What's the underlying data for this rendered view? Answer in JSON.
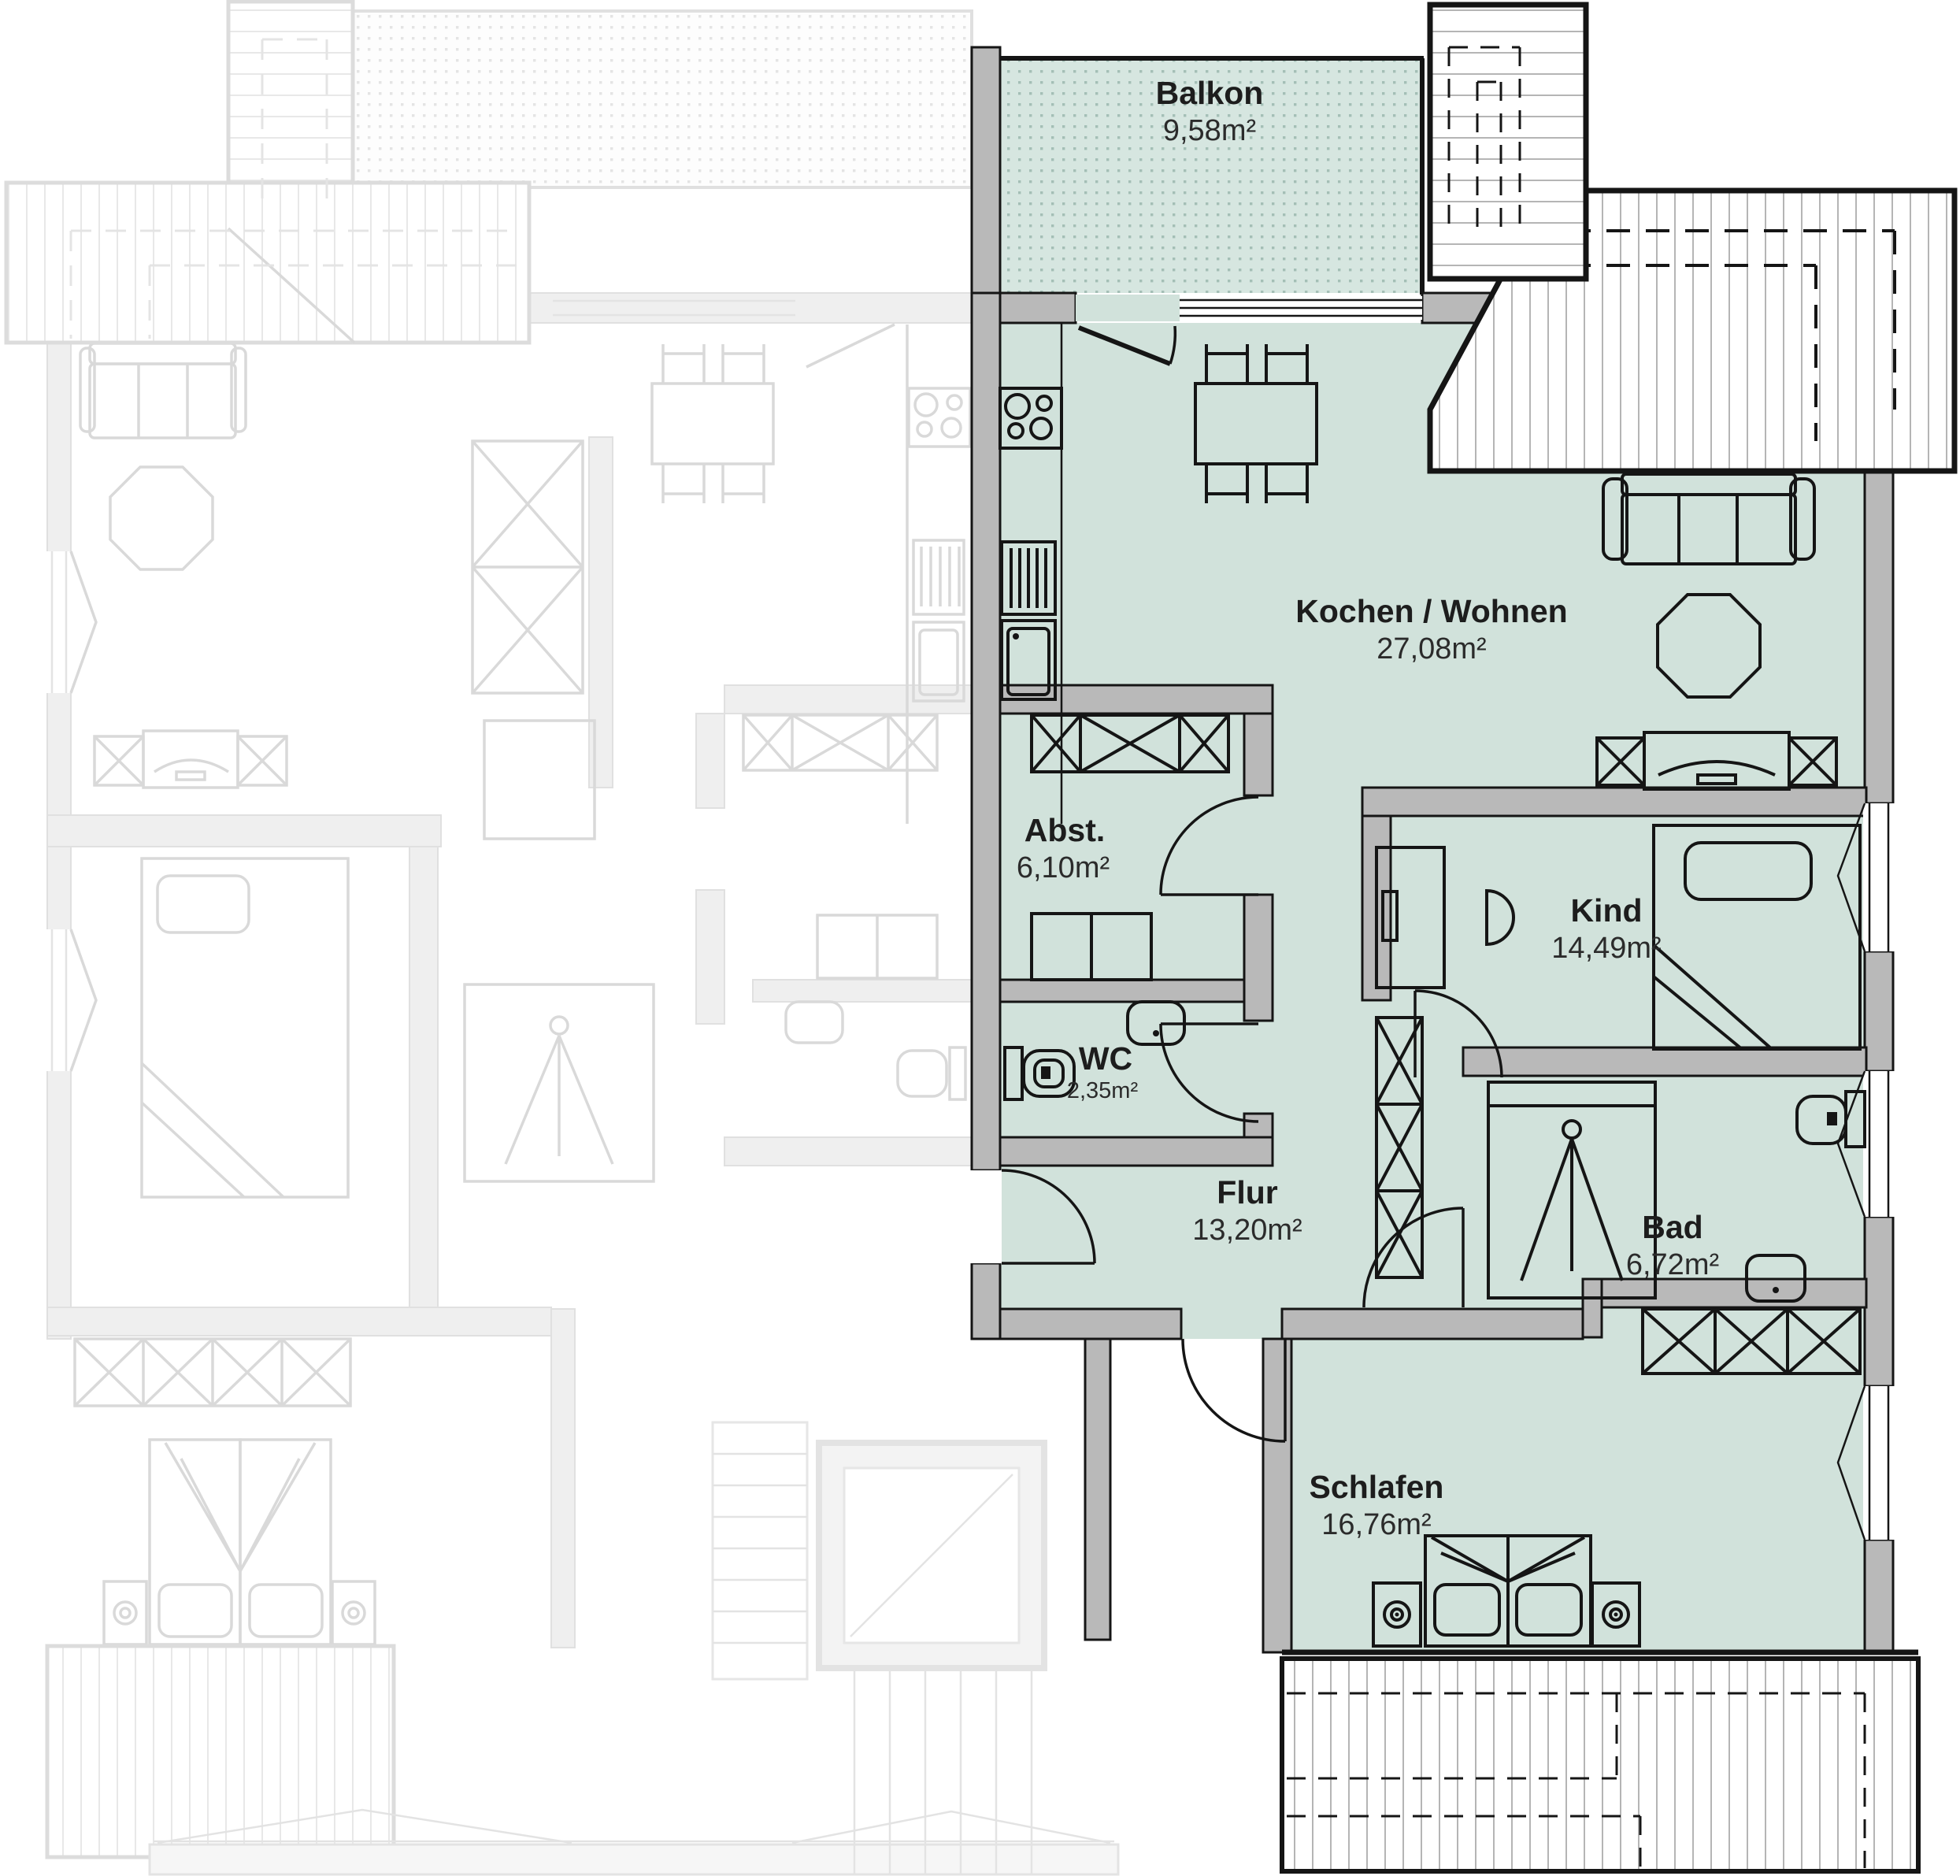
{
  "plan": {
    "type": "apartment-floor-plan",
    "highlighted_unit": {
      "rooms": [
        {
          "name": "Balkon",
          "area": "9,58m²"
        },
        {
          "name": "Kochen / Wohnen",
          "area": "27,08m²"
        },
        {
          "name": "Abst.",
          "area": "6,10m²"
        },
        {
          "name": "Kind",
          "area": "14,49m²"
        },
        {
          "name": "WC",
          "area": "2,35m²"
        },
        {
          "name": "Flur",
          "area": "13,20m²"
        },
        {
          "name": "Bad",
          "area": "6,72m²"
        },
        {
          "name": "Schlafen",
          "area": "16,76m²"
        }
      ]
    },
    "colors": {
      "room_fill": "#d1e2db",
      "balcony_tile": "#d6e6e0",
      "balcony_dot": "#a4bfb6",
      "wall_fill": "#b9b9b9",
      "line": "#151515",
      "faded": "#d9d9d9"
    }
  }
}
